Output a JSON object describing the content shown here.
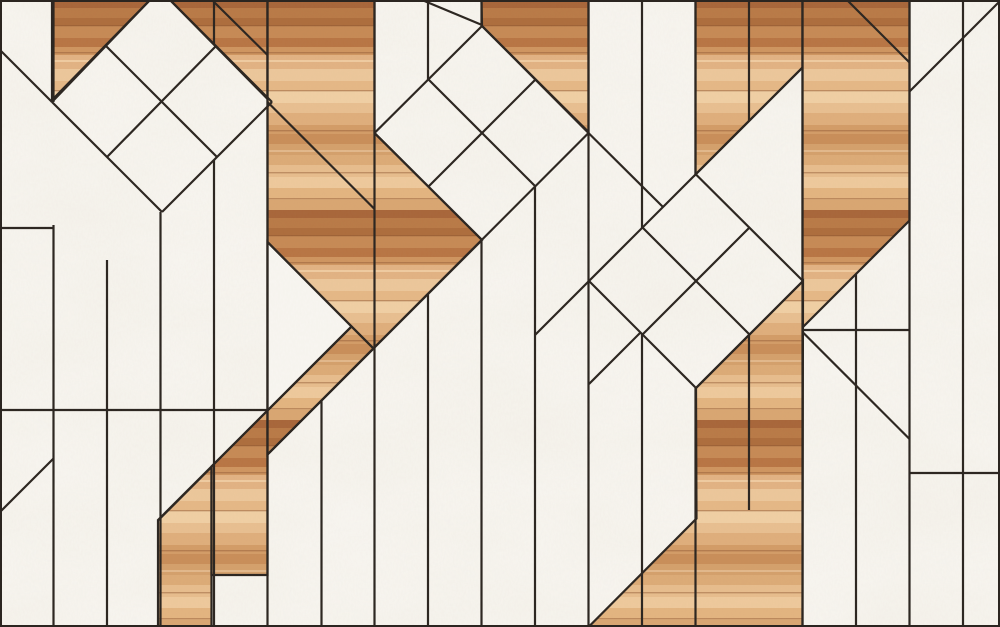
{
  "image": {
    "kind": "parquet-marble-wood-pattern",
    "width": 1000,
    "height": 627,
    "plank_pitch": 53.5
  },
  "palette": {
    "marble_base": "#f8f6f1",
    "marble_vein": "#d9d2c2",
    "seam_color": "#2b2520",
    "wood_dark": "#a8663a",
    "wood_mid": "#d8a06a",
    "wood_light": "#ecc79b"
  },
  "diamonds": [
    {
      "name": "diamond-top-left",
      "cx": 161,
      "cy": 102,
      "half_diagonal": 110
    },
    {
      "name": "diamond-center",
      "cx": 482,
      "cy": 133,
      "half_diagonal": 107
    },
    {
      "name": "diamond-right",
      "cx": 696,
      "cy": 281,
      "half_diagonal": 107
    }
  ],
  "wood_stripes": [
    {
      "y": 0,
      "h": 8,
      "c": "#a8663a"
    },
    {
      "y": 8,
      "h": 10,
      "c": "#b97a47"
    },
    {
      "y": 18,
      "h": 8,
      "c": "#ad6d3d"
    },
    {
      "y": 26,
      "h": 12,
      "c": "#c68a55"
    },
    {
      "y": 38,
      "h": 9,
      "c": "#b87544"
    },
    {
      "y": 47,
      "h": 8,
      "c": "#cf9560"
    },
    {
      "y": 55,
      "h": 14,
      "c": "#e2b283"
    },
    {
      "y": 69,
      "h": 12,
      "c": "#ecc79b"
    },
    {
      "y": 81,
      "h": 10,
      "c": "#e5b886"
    },
    {
      "y": 91,
      "h": 12,
      "c": "#f0cfa4"
    },
    {
      "y": 103,
      "h": 10,
      "c": "#e8bf90"
    },
    {
      "y": 113,
      "h": 12,
      "c": "#dfae7c"
    },
    {
      "y": 125,
      "h": 9,
      "c": "#d39c67"
    },
    {
      "y": 134,
      "h": 10,
      "c": "#c98e59"
    },
    {
      "y": 144,
      "h": 11,
      "c": "#d4a06c"
    },
    {
      "y": 155,
      "h": 10,
      "c": "#dcab77"
    },
    {
      "y": 165,
      "h": 12,
      "c": "#e7bd8d"
    },
    {
      "y": 177,
      "h": 11,
      "c": "#eec99c"
    },
    {
      "y": 188,
      "h": 12,
      "c": "#e3b480"
    },
    {
      "y": 200,
      "h": 10,
      "c": "#d9a672"
    }
  ],
  "wood_grain_lines": [
    25,
    52,
    90,
    130,
    172,
    198
  ],
  "wood_polygons": [
    {
      "name": "wood-top-left-triangle",
      "points": "52,0 150,0 52,100"
    },
    {
      "name": "wood-beside-diamond1",
      "points": "170,0 267.5,0 267.5,99"
    },
    {
      "name": "wood-center-column",
      "points": "267.5,0 374.5,0 374.5,133 482,240 267.5,454.5"
    },
    {
      "name": "wood-strip-lower-left-a",
      "points": "158,520.5 211.5,467 211.5,627 158,627"
    },
    {
      "name": "wood-strip-lower-left-b",
      "points": "211.5,466.5 267.5,410.5 267.5,575 211.5,575"
    },
    {
      "name": "wood-diagonal-band",
      "points": "267.5,410.5 351.5,326.5 373.5,348.5 267.5,454.5"
    },
    {
      "name": "wood-top-middle",
      "points": "481.5,0 588.5,0 588.5,132 482,26"
    },
    {
      "name": "wood-top-right-a",
      "points": "695.5,0 802.5,0 802.5,67.5 695.5,174.5"
    },
    {
      "name": "wood-top-right-column",
      "points": "802.5,0 909.5,0 909.5,220.5 802.5,327.5"
    },
    {
      "name": "wood-bottom-right-column",
      "points": "696,388 749.5,334.5 803,281 802.5,627 589,626.5 696.5,518.5"
    }
  ],
  "marble_overlay_polygons": [
    {
      "name": "marble-notch-triangle",
      "points": "267.5,242 351.5,326.5 267.5,410.5"
    }
  ],
  "seam_lines": [
    [
      53.5,
      0,
      53.5,
      102
    ],
    [
      53.5,
      225,
      53.5,
      627
    ],
    [
      107,
      260,
      107,
      627
    ],
    [
      160.5,
      212,
      160.5,
      627
    ],
    [
      214,
      0,
      214,
      44
    ],
    [
      214,
      160,
      214,
      627
    ],
    [
      267.5,
      0,
      267.5,
      627
    ],
    [
      321.5,
      400.5,
      321.5,
      627
    ],
    [
      374.5,
      0,
      374.5,
      627
    ],
    [
      428,
      0,
      428,
      80
    ],
    [
      428,
      294,
      428,
      627
    ],
    [
      481.5,
      0,
      481.5,
      26
    ],
    [
      481.5,
      240,
      481.5,
      627
    ],
    [
      535,
      187,
      535,
      627
    ],
    [
      588.5,
      0,
      588.5,
      627
    ],
    [
      642,
      0,
      642,
      228
    ],
    [
      642,
      334,
      642,
      627
    ],
    [
      695.5,
      0,
      695.5,
      174
    ],
    [
      695.5,
      388,
      695.5,
      627
    ],
    [
      749,
      0,
      749,
      121
    ],
    [
      749,
      334.5,
      749,
      510
    ],
    [
      802.5,
      0,
      802.5,
      627
    ],
    [
      856,
      274,
      856,
      627
    ],
    [
      909.5,
      0,
      909.5,
      627
    ],
    [
      963,
      0,
      963,
      627
    ],
    [
      0,
      228,
      53.5,
      228
    ],
    [
      0,
      410,
      267.5,
      410
    ],
    [
      802.5,
      330,
      909.5,
      330
    ],
    [
      909.5,
      473,
      1000,
      473
    ],
    [
      150,
      0,
      52,
      102
    ],
    [
      52,
      102,
      162,
      212
    ],
    [
      162,
      212,
      272,
      102
    ],
    [
      170,
      0,
      272,
      102
    ],
    [
      106,
      46,
      217,
      157
    ],
    [
      216,
      46,
      107,
      157
    ],
    [
      0,
      50,
      52,
      102
    ],
    [
      212,
      0,
      267.5,
      55
    ],
    [
      267.5,
      102,
      374.5,
      209
    ],
    [
      482,
      26,
      374.5,
      133
    ],
    [
      374.5,
      133,
      482,
      240
    ],
    [
      482,
      26,
      588.5,
      133
    ],
    [
      588.5,
      133,
      267.5,
      454.5
    ],
    [
      428.5,
      79.5,
      535.5,
      186.5
    ],
    [
      535.5,
      79.5,
      428.5,
      186.5
    ],
    [
      482,
      25,
      422,
      0
    ],
    [
      588.5,
      133,
      663,
      207
    ],
    [
      157.5,
      520.5,
      351.5,
      326.5
    ],
    [
      267.5,
      242,
      373.5,
      348.5
    ],
    [
      535,
      335,
      802.5,
      67.5
    ],
    [
      695.5,
      174,
      803,
      281
    ],
    [
      589,
      281,
      696,
      388
    ],
    [
      803,
      281,
      696,
      388
    ],
    [
      642.5,
      227.5,
      749.5,
      334.5
    ],
    [
      749.5,
      227.5,
      642.5,
      334.5
    ],
    [
      589,
      384,
      640.5,
      332.5
    ],
    [
      847,
      0,
      909.5,
      62.5
    ],
    [
      802.5,
      332,
      909.5,
      439
    ],
    [
      909.5,
      91.5,
      1000,
      1
    ],
    [
      0,
      512,
      53.5,
      458.5
    ]
  ]
}
